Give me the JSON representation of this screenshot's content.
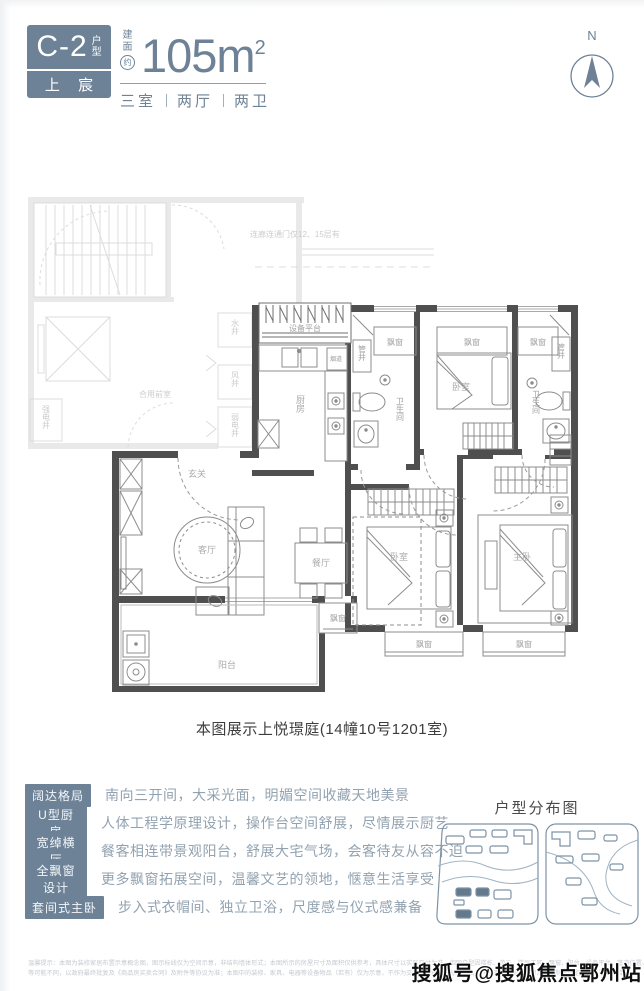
{
  "colors": {
    "slate": "#6d8297",
    "wall_dark": "#4f4f4f",
    "ghost": "#d9d9d9",
    "feature_text": "#92a2b0"
  },
  "header": {
    "unit_code": "C-2",
    "unit_type_chars": {
      "c1": "户",
      "c2": "型"
    },
    "brand": "上 宸",
    "area_prefix": {
      "c1": "建",
      "c2": "面",
      "c3": "约"
    },
    "area_value": "105m",
    "area_exponent": "2",
    "rooms_summary": {
      "part1": "三室",
      "part2": "两厅",
      "part3": "两卫"
    },
    "north_label": "N"
  },
  "plan": {
    "caption": "本图展示上悦璟庭(14幢10号1201室)",
    "rooms": {
      "entry": "玄关",
      "living": "客厅",
      "dining": "餐厅",
      "kitchen": "厨房",
      "balcony": "阳台",
      "bedroom": "卧室",
      "master": "主卧",
      "bath": "卫生间",
      "bay_window": "飘窗",
      "equipment": "设备平台",
      "flue": "烟道",
      "pipe_shaft": "管井"
    },
    "ghost": {
      "corridor_note": "连廊连通门仅12、15层有",
      "lobby": "合用前室",
      "water_shaft": "水井",
      "air_shaft": "风井",
      "weak_elec": "弱电井",
      "strong_elec": "强电井"
    }
  },
  "features": [
    {
      "label": "阔达格局",
      "desc": "南向三开间，大采光面，明媚空间收藏天地美景"
    },
    {
      "label": "U型厨房",
      "desc": "人体工程学原理设计，操作台空间舒展，尽情展示厨艺"
    },
    {
      "label": "宽绰横厅",
      "desc": "餐客相连带景观阳台，舒展大宅气场，会客待友从容不迫"
    },
    {
      "label": "全飘窗设计",
      "desc": "更多飘窗拓展空间，温馨文艺的领地，惬意生活享受"
    },
    {
      "label": "套间式主卧",
      "desc": "步入式衣帽间、独立卫浴，尺度感与仪式感兼备"
    }
  ],
  "distribution": {
    "title": "户型分布图"
  },
  "disclaimer": {
    "line1": "温馨提示：本图为装修家居布置示意概念图，图示标线仅为空间示意，非结构墙体形式；本图所示的房屋尺寸及面积仅供参考，具体尺寸以实际交付为准。相同户型因楼栋、单元、楼层不同，飘窗、阳台、设备平台、管道位置、外立面、空调平台",
    "line2": "等可能不同，以政府最终批复及《商品房买卖合同》及附件等协议为准；本图中的装修、家具、电器等设备物品（若有）仅为示意，不作为交付内容和交付标准。出卖人在不违反国家法律法规强制性规定下保留最终解释权。"
  },
  "watermark": "搜狐号@搜狐焦点鄂州站"
}
